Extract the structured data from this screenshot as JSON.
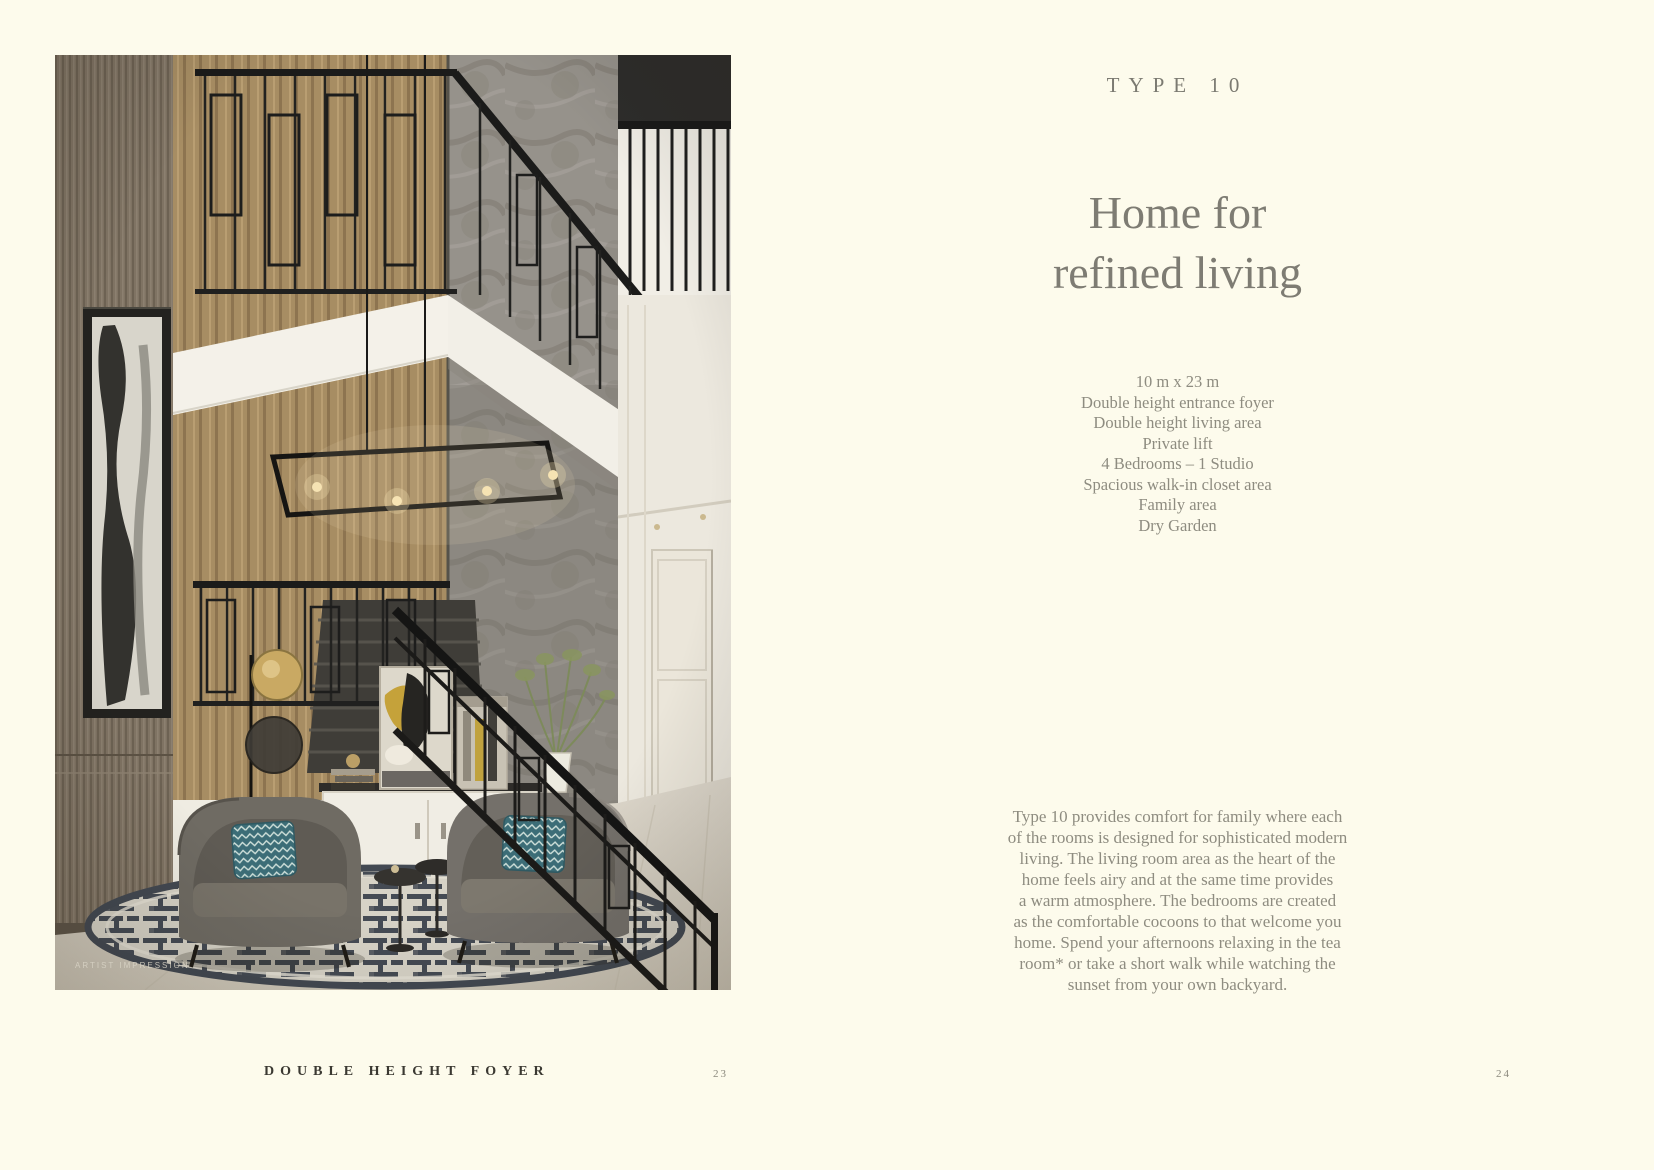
{
  "photo": {
    "caption": "ARTIST IMPRESSION"
  },
  "content": {
    "eyebrow": "TYPE 10",
    "title_lines": [
      "Home for",
      "refined living"
    ],
    "specs": [
      "10 m x 23 m",
      "Double height entrance foyer",
      "Double height living area",
      "Private lift",
      "4 Bedrooms – 1 Studio",
      "Spacious walk-in closet area",
      "Family area",
      "Dry Garden"
    ],
    "paragraph_lines": [
      "Type 10 provides comfort for family where each",
      "of the rooms is designed for sophisticated modern",
      "living. The living room area as the heart of the",
      "home feels airy and at the same time provides",
      "a warm atmosphere. The bedrooms are created",
      "as the comfortable cocoons to that welcome you",
      "home. Spend your afternoons relaxing in the tea",
      "room* or take a short walk while watching the",
      "sunset from your own backyard."
    ]
  },
  "footer": {
    "label": "DOUBLE HEIGHT FOYER",
    "page_left": "23",
    "page_right": "24"
  },
  "colors": {
    "background": "#fdfbec",
    "body_text": "#8e8c80",
    "title_text": "#7e7c73",
    "footer_text": "#3b3932"
  }
}
